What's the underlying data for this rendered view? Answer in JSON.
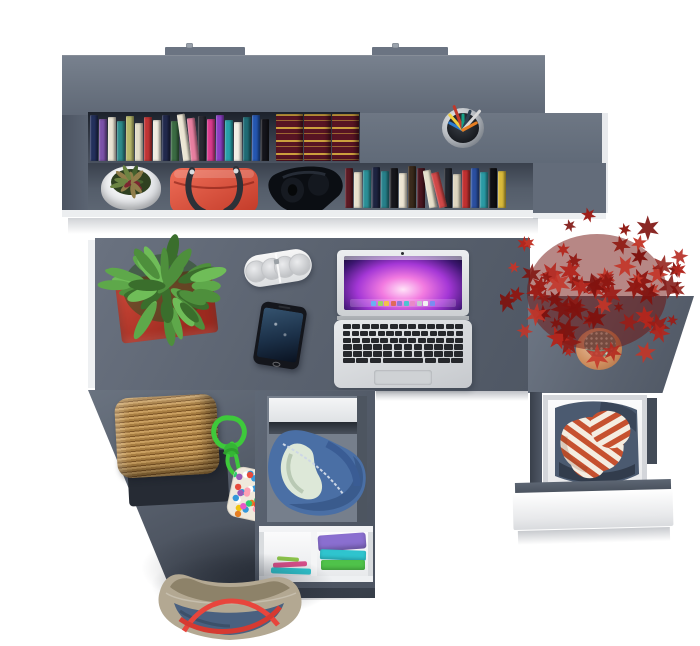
{
  "scene": {
    "description": "Top-down product render of a gray home-office desk set: wall shelf with books, desk with laptop, phone, speaker and plant, side unit with red maple plant and open clothes drawer, lower storage with duffel bag and folded clothes, wicker stool and tote bag",
    "background_color": "#ffffff",
    "furniture_gray": "#5d6571",
    "furniture_gray_light": "#6f7989",
    "furniture_gray_dark": "#474f5b",
    "white_edge_color": "#eef0f2"
  },
  "hutch": {
    "label": "wall shelf",
    "mount_tab_count": 2,
    "top_books": [
      {
        "c": "#23305c",
        "h": 46
      },
      {
        "c": "#7b52a8",
        "h": 42
      },
      {
        "c": "#e9e3d3",
        "h": 44
      },
      {
        "c": "#2e8b8b",
        "h": 40
      },
      {
        "c": "#b7b86b",
        "h": 45
      },
      {
        "c": "#e2dcc8",
        "h": 38
      },
      {
        "c": "#c03434",
        "h": 44
      },
      {
        "c": "#f0ece0",
        "h": 41
      },
      {
        "c": "#21294d",
        "h": 46
      },
      {
        "c": "#3a6b42",
        "h": 40
      },
      {
        "c": "#ece6d4",
        "h": 47,
        "lean": -8
      },
      {
        "c": "#e77fa0",
        "h": 43,
        "lean": -6
      },
      {
        "c": "#2a2a33",
        "h": 45
      },
      {
        "c": "#d93a8c",
        "h": 42
      },
      {
        "c": "#8a3fc2",
        "h": 46
      },
      {
        "c": "#27a0a8",
        "h": 41
      },
      {
        "c": "#f2eee4",
        "h": 39
      },
      {
        "c": "#1f6b74",
        "h": 44
      },
      {
        "c": "#2456b0",
        "h": 46
      },
      {
        "c": "#14141a",
        "h": 42
      }
    ],
    "ornate_books": {
      "count": 3,
      "color": "#581423",
      "band_color": "#d8ae40",
      "width": 27,
      "height": 47
    },
    "lower_books": [
      {
        "c": "#5c1a24",
        "h": 40
      },
      {
        "c": "#e8e0cc",
        "h": 36
      },
      {
        "c": "#2a8f96",
        "h": 38
      },
      {
        "c": "#1d2440",
        "h": 41
      },
      {
        "c": "#27808a",
        "h": 37
      },
      {
        "c": "#17171c",
        "h": 40
      },
      {
        "c": "#ece5d2",
        "h": 35
      },
      {
        "c": "#3a2a1c",
        "h": 42
      },
      {
        "c": "#4a1620",
        "h": 40
      },
      {
        "c": "#e6dfcb",
        "h": 38,
        "lean": -10
      },
      {
        "c": "#d04848",
        "h": 36,
        "lean": -14
      },
      {
        "c": "#20242c",
        "h": 40
      },
      {
        "c": "#ded6c0",
        "h": 34
      },
      {
        "c": "#c03030",
        "h": 38
      },
      {
        "c": "#2a4fa0",
        "h": 40
      },
      {
        "c": "#2a9aa4",
        "h": 36
      },
      {
        "c": "#101014",
        "h": 40
      },
      {
        "c": "#d8b93a",
        "h": 37
      }
    ],
    "pen_cup": {
      "cup_color": "#9aa0a6",
      "pen_colors": [
        "#2d7dd2",
        "#f4d03f",
        "#c0392b",
        "#16a085",
        "#2c3e50",
        "#d8d8d8",
        "#e67e22"
      ]
    },
    "flower_pot": {
      "pot_color": "#f2f3f5",
      "foliage_colors": [
        "#44602e",
        "#6b8442",
        "#7c2630",
        "#907d4a"
      ]
    },
    "handbag": {
      "body_color": "#d94f3e",
      "handle_color": "#2d3138"
    },
    "headphones_color": "#0b0e13"
  },
  "desk": {
    "plant": {
      "pot_color": "#b23227",
      "leaf_colors": [
        "#3a6e2c",
        "#4e8f3c",
        "#5ea84a",
        "#6fbd58"
      ]
    },
    "speaker": {
      "body_color": "#f0f0f0",
      "grille_color": "#c9cbcd"
    },
    "phone": {
      "body_color": "#14161c",
      "screen_colors": [
        "#35536f",
        "#0a1220"
      ]
    },
    "laptop": {
      "body_color": "#dfe1e4",
      "key_color": "#26282c",
      "wallpaper_colors": [
        "#ffe3f8",
        "#f27ae0",
        "#a437d6",
        "#140a33"
      ],
      "keyboard_rows": [
        13,
        14,
        13,
        12,
        12
      ],
      "dock_colors": [
        "#6ab0f3",
        "#9bd468",
        "#f3c14b",
        "#e06a5a",
        "#8e7bd8",
        "#4fc3d0",
        "#e889c8",
        "#c5c9cf",
        "#f2f2f2",
        "#7a8cf0"
      ]
    }
  },
  "side_unit": {
    "maple": {
      "leaf_colors": [
        "#7e120e",
        "#9c1c16",
        "#b3261d",
        "#8f1812",
        "#c33528"
      ],
      "leaf_count": 70,
      "pot_color": "#d8a183"
    },
    "drawer": {
      "front_color": "#fafbfc",
      "shirt_stripe_color": "#c6512f",
      "shirt_base_color": "#f4ede1",
      "jeans_color": "#4b5a70"
    }
  },
  "cabinet": {
    "duffel": {
      "body_color": "#4a6fa5",
      "lining_color": "#dde8d8"
    },
    "shelf_clothes_stack": [
      "#8a6fd0",
      "#2fc4ce",
      "#4fc24a"
    ],
    "shelf_clothes_strips": [
      "#d94f8a",
      "#2fc4ce",
      "#8bc34a"
    ]
  },
  "floor": {
    "stool": {
      "weave_light": "#caa061",
      "weave_dark": "#7d5526",
      "mat_color": "#262b34"
    },
    "rope_toy": {
      "rope_color": "#3ec93b",
      "pompom_colors": [
        "#e74c3c",
        "#3498db",
        "#f1c40f",
        "#2ecc71",
        "#e858c8",
        "#e67e22",
        "#ffffff",
        "#9b59b6",
        "#1abc9c",
        "#ffa0b4"
      ]
    },
    "tote": {
      "canvas_color": "#b3a892",
      "denim_color": "#4a6180",
      "strap_color": "#e8453c"
    }
  }
}
